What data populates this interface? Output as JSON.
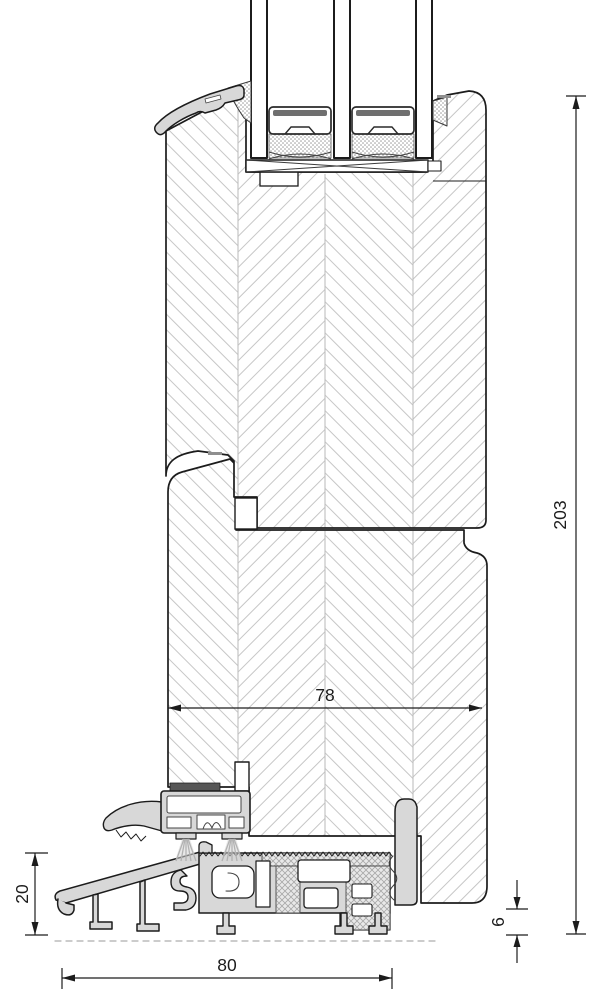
{
  "drawing": {
    "kind": "technical-section-drawing",
    "subject": "door threshold vertical cross-section",
    "colors": {
      "outline": "#1c1c1c",
      "wood_hatch": "#c6c6c6",
      "aluminum_fill": "#d8d8d8",
      "seal_dark": "#565656",
      "sealant_dots": "#9a9a9a",
      "thermal_break_hatch": "#b0b0b0",
      "brush_gray": "#b2b2b2",
      "background": "#ffffff"
    },
    "dimensions": {
      "overall_height": "203",
      "frame_depth": "78",
      "threshold_front_height": "20",
      "bottom_clearance": "6",
      "threshold_width": "80"
    }
  }
}
